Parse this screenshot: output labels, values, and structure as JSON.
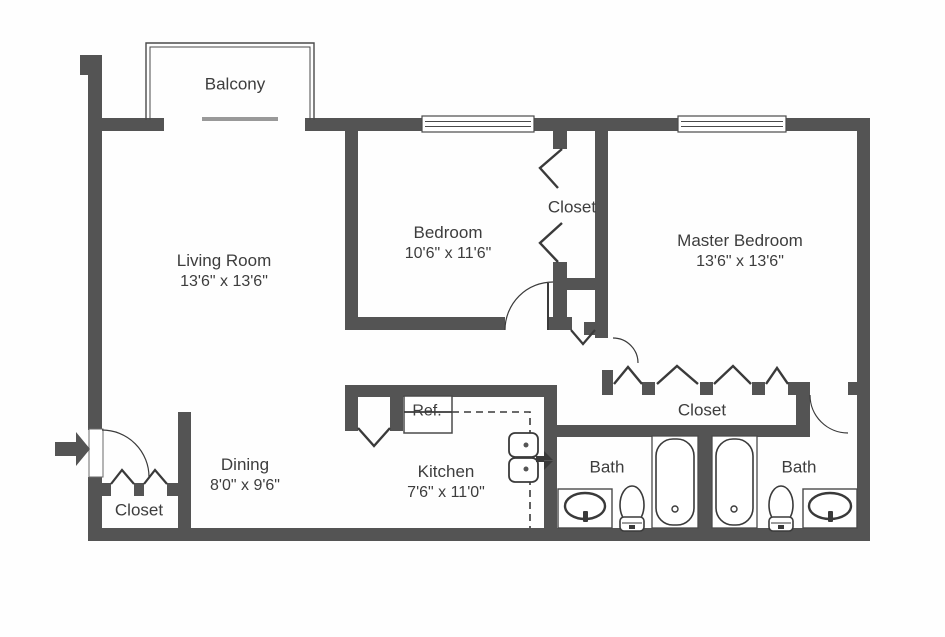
{
  "colors": {
    "wall": "#545454",
    "line": "#3a3a3a",
    "text": "#3d3d3d",
    "background": "#fefefe"
  },
  "rooms": {
    "balcony": {
      "label": "Balcony"
    },
    "living_room": {
      "label": "Living Room",
      "dimensions": "13'6\" x 13'6\""
    },
    "bedroom": {
      "label": "Bedroom",
      "dimensions": "10'6\" x 11'6\""
    },
    "bedroom_closet": {
      "label": "Closet"
    },
    "master_bedroom": {
      "label": "Master Bedroom",
      "dimensions": "13'6\" x 13'6\""
    },
    "dining": {
      "label": "Dining",
      "dimensions": "8'0\" x 9'6\""
    },
    "entry_closet": {
      "label": "Closet"
    },
    "kitchen": {
      "label": "Kitchen",
      "dimensions": "7'6\" x 11'0\""
    },
    "bath_left": {
      "label": "Bath"
    },
    "hall_closet": {
      "label": "Closet"
    },
    "bath_right": {
      "label": "Bath"
    }
  },
  "appliances": {
    "refrigerator": {
      "label": "Ref."
    }
  }
}
